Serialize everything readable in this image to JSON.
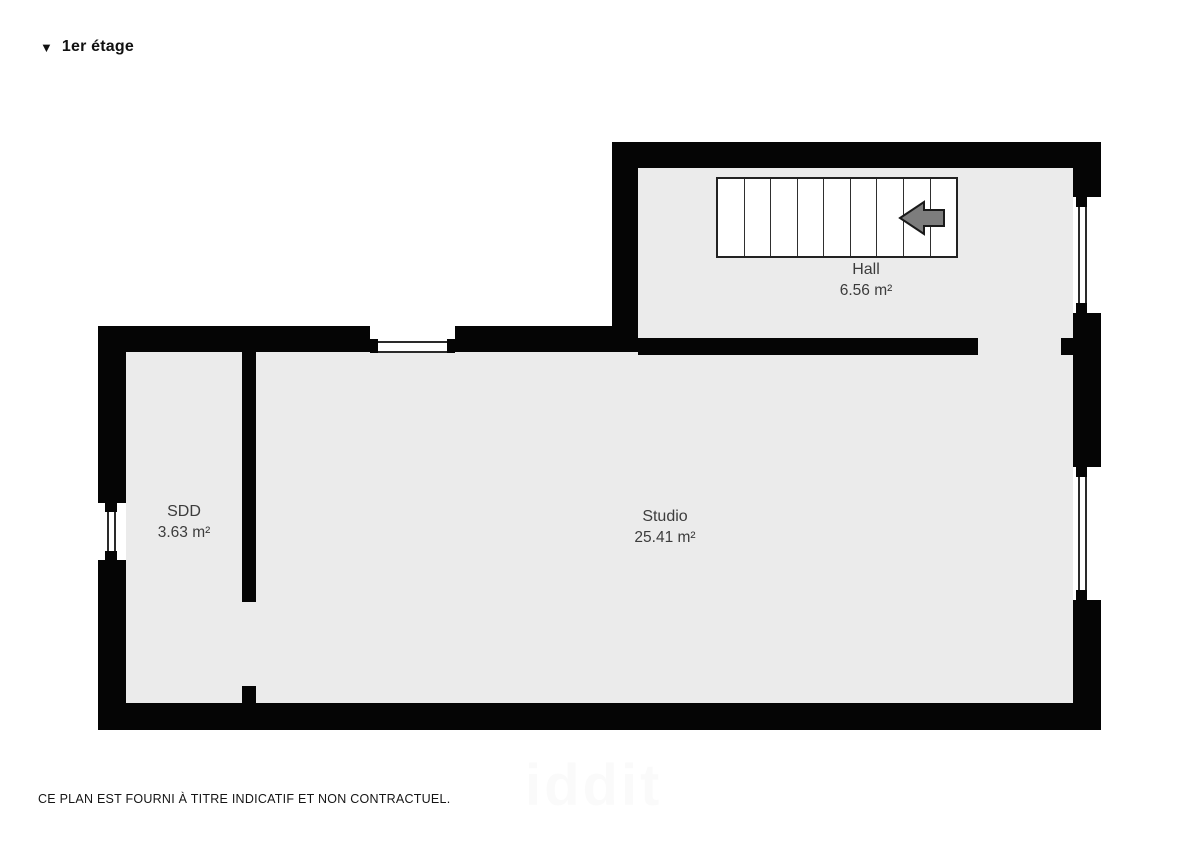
{
  "title": {
    "marker": "▼",
    "label": "1er étage"
  },
  "rooms": [
    {
      "id": "hall",
      "name": "Hall",
      "area": "6.56 m²"
    },
    {
      "id": "sdd",
      "name": "SDD",
      "area": "3.63 m²"
    },
    {
      "id": "studio",
      "name": "Studio",
      "area": "25.41 m²"
    }
  ],
  "stairs": {
    "treads": 9,
    "direction": "left"
  },
  "disclaimer": "CE PLAN EST FOURNI À TITRE INDICATIF ET NON CONTRACTUEL.",
  "watermark": "iddit",
  "colors": {
    "wall": "#050505",
    "floor": "#ebebeb",
    "stairs_fill": "#ffffff",
    "stairs_border": "#222222",
    "arrow_fill": "#7d7d7d",
    "arrow_border": "#1a1a1a",
    "label_text": "#3c3c3c",
    "title_text": "#111111",
    "disclaimer_text": "#151515"
  }
}
